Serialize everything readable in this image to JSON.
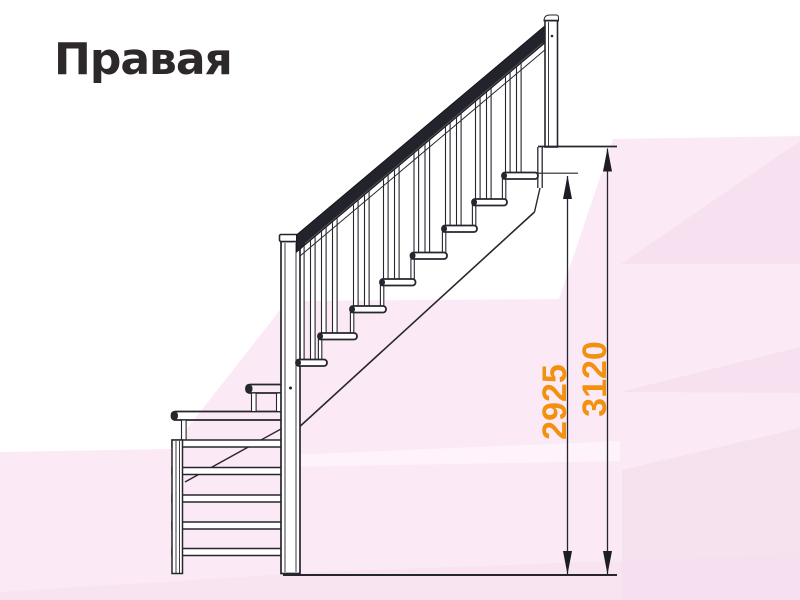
{
  "title": "Правая",
  "drawing": {
    "kind": "staircase-side-elevation",
    "handing_label": "Правая",
    "straight_treads": 8,
    "lower_winder_steps": 7
  },
  "dimensions": [
    {
      "id": "height-to-top-tread",
      "value": "2925"
    },
    {
      "id": "total-height",
      "value": "3120"
    }
  ],
  "colors": {
    "dimension_text": "#F29110",
    "title_text": "#2D292B",
    "linework": "#26262E",
    "background_tint": "#FBEAF5"
  }
}
